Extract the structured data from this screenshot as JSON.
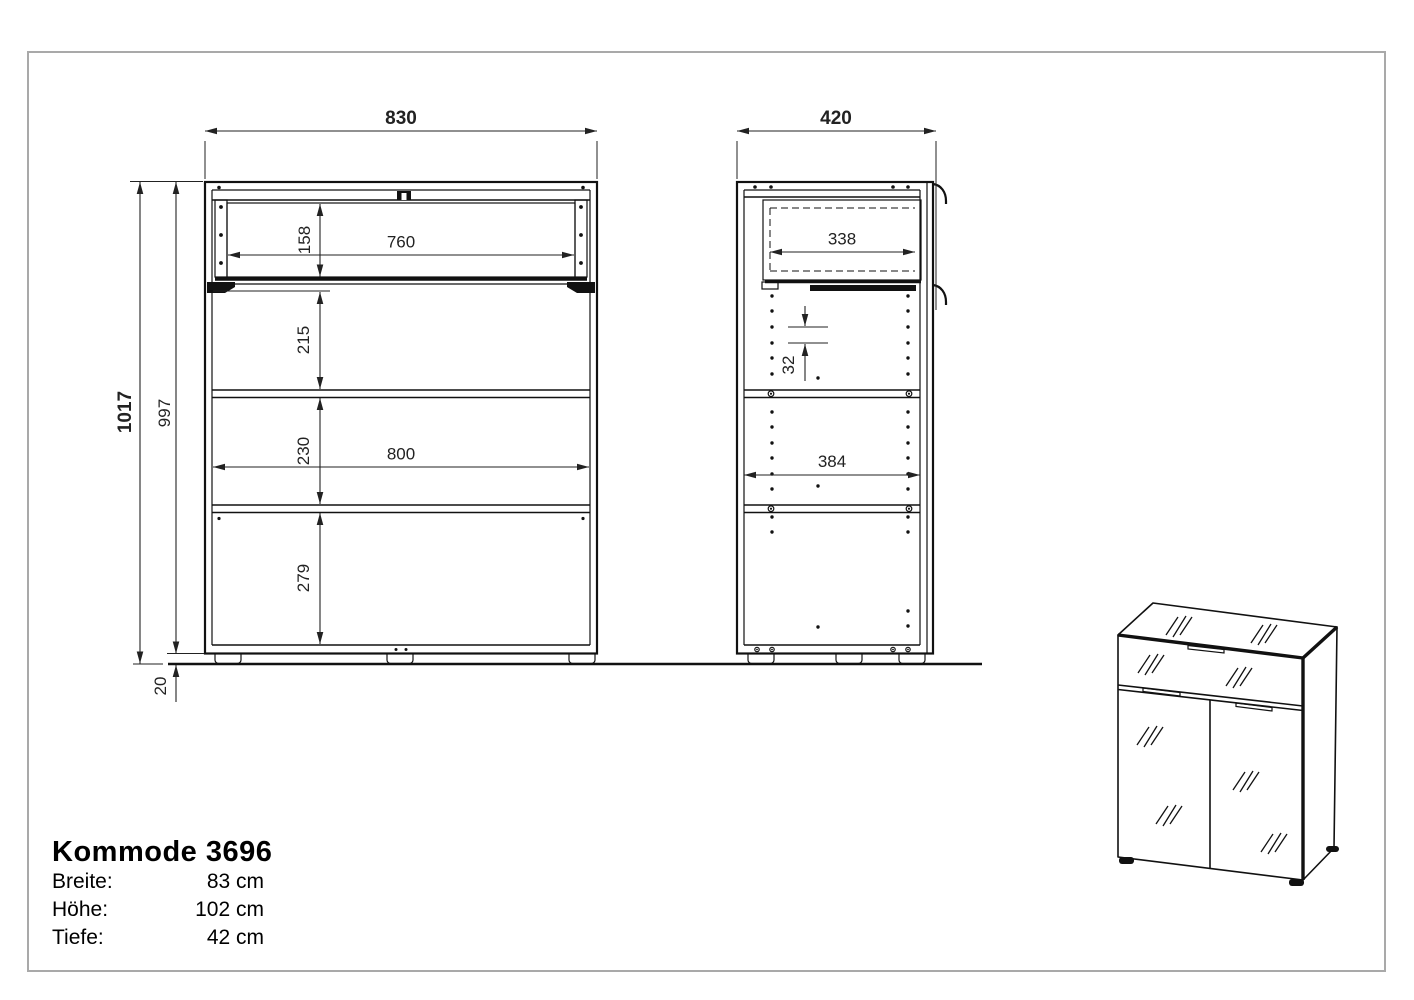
{
  "page": {
    "background": "#ffffff",
    "frame_color": "#a9a9a9",
    "line_color": "#111111",
    "dim_color": "#222222"
  },
  "title_block": {
    "title": "Kommode 3696",
    "specs": [
      {
        "label": "Breite:",
        "value": "83 cm"
      },
      {
        "label": "Höhe:",
        "value": "102 cm"
      },
      {
        "label": "Tiefe:",
        "value": "42 cm"
      }
    ]
  },
  "dims": {
    "front": {
      "width": "830",
      "drawer_width": "760",
      "drawer_height": "158",
      "upper_gap": "215",
      "middle_gap": "230",
      "inner_width": "800",
      "lower_gap": "279",
      "total_height": "1017",
      "body_height": "997",
      "feet_height": "20"
    },
    "side": {
      "depth": "420",
      "drawer_depth": "338",
      "hole_pitch": "32",
      "inner_depth": "384"
    }
  }
}
